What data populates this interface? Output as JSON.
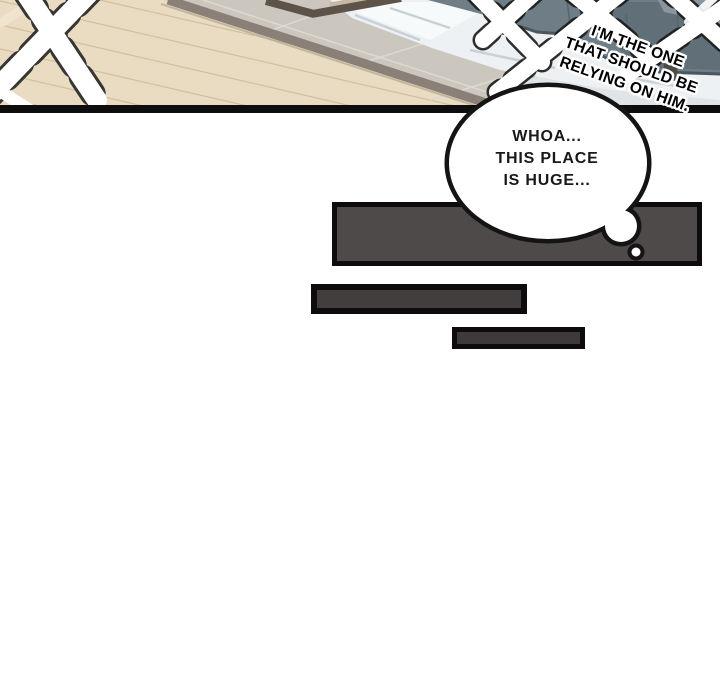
{
  "page": {
    "kind": "webtoon comic page",
    "background": "#ffffff"
  },
  "panel": {
    "caption": {
      "lines": [
        "I'M THE ONE",
        "THAT SHOULD BE",
        "RELYING ON HIM."
      ],
      "text_color": "#000000",
      "outline_color": "#ffffff"
    },
    "colors": {
      "wood_floor": "#e9dcc2",
      "plank_line": "#c9b795",
      "area_rug": "#cbc7bf",
      "rug_edge": "#8a8077",
      "table_edge": "#5e5349",
      "table_top": "#c9b8a2",
      "sofa": "#6f7d86",
      "sofa_dark": "#5e6c76",
      "blanket": "#edf1f4",
      "floor_light": "#e1e4e6",
      "flash": "#ffffff",
      "panel_border": "#0d0d0d"
    }
  },
  "thought_bubble": {
    "lines": [
      "WHOA...",
      "THIS PLACE",
      "IS HUGE..."
    ],
    "fill": "#ffffff",
    "outline": "#141414",
    "text_color": "#191919"
  },
  "redacted_bars": {
    "large": {
      "fill": "#4f4a4a",
      "outline": "#0d0b0b"
    },
    "medium": {
      "fill": "#433e3e",
      "outline": "#0d0b0b"
    },
    "small": {
      "fill": "#3e3a3a",
      "outline": "#0d0b0b"
    }
  }
}
